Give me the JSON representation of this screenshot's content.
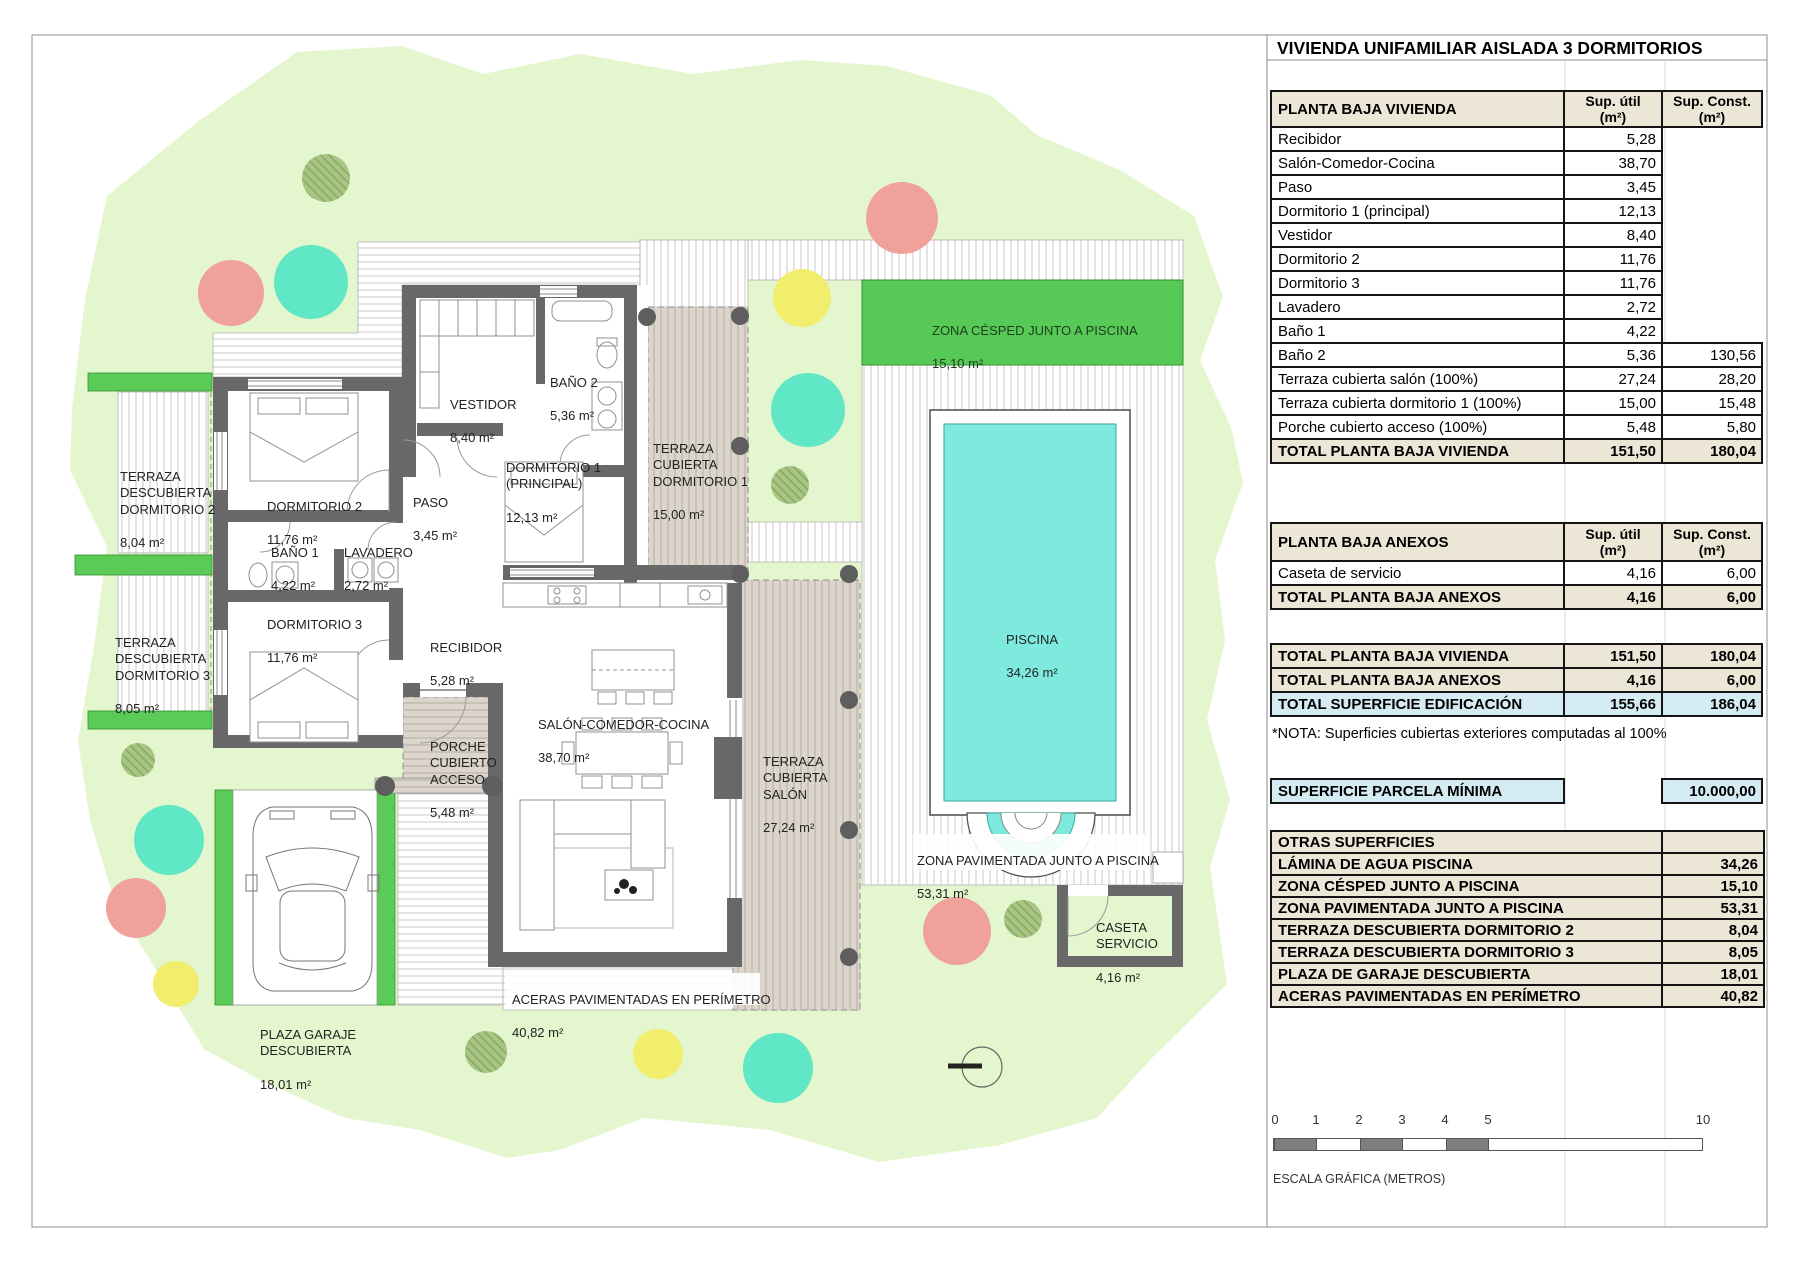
{
  "title": "VIVIENDA UNIFAMILIAR AISLADA 3 DORMITORIOS",
  "colors": {
    "garden": "#e3f6cd",
    "grass_bright": "#57c957",
    "pool_water": "#7eeade",
    "wall": "#686868",
    "terrace_beige": "#dcd5cb",
    "table_header_beige": "#ece6d7",
    "highlight_blue": "#d4ebf4",
    "tree_salmon": "#efa19a",
    "tree_teal": "#5fe7c6",
    "tree_yellow": "#f1ee6d",
    "tree_olive": "#a8c584"
  },
  "col_headers": {
    "util": "Sup. útil\n(m²)",
    "const": "Sup. Const.\n(m²)"
  },
  "tables": {
    "vivienda": {
      "header": "PLANTA BAJA VIVIENDA",
      "rows": [
        {
          "label": "Recibidor",
          "util": "5,28",
          "const": ""
        },
        {
          "label": "Salón-Comedor-Cocina",
          "util": "38,70",
          "const": ""
        },
        {
          "label": "Paso",
          "util": "3,45",
          "const": ""
        },
        {
          "label": "Dormitorio 1 (principal)",
          "util": "12,13",
          "const": ""
        },
        {
          "label": "Vestidor",
          "util": "8,40",
          "const": ""
        },
        {
          "label": "Dormitorio 2",
          "util": "11,76",
          "const": ""
        },
        {
          "label": "Dormitorio 3",
          "util": "11,76",
          "const": ""
        },
        {
          "label": "Lavadero",
          "util": "2,72",
          "const": ""
        },
        {
          "label": "Baño 1",
          "util": "4,22",
          "const": ""
        },
        {
          "label": "Baño 2",
          "util": "5,36",
          "const": "130,56"
        },
        {
          "label": "Terraza cubierta salón (100%)",
          "util": "27,24",
          "const": "28,20"
        },
        {
          "label": "Terraza cubierta dormitorio 1 (100%)",
          "util": "15,00",
          "const": "15,48"
        },
        {
          "label": "Porche cubierto acceso (100%)",
          "util": "5,48",
          "const": "5,80"
        }
      ],
      "total": {
        "label": "TOTAL PLANTA BAJA VIVIENDA",
        "util": "151,50",
        "const": "180,04"
      }
    },
    "anexos": {
      "header": "PLANTA BAJA ANEXOS",
      "rows": [
        {
          "label": "Caseta de servicio",
          "util": "4,16",
          "const": "6,00"
        }
      ],
      "total": {
        "label": "TOTAL PLANTA BAJA ANEXOS",
        "util": "4,16",
        "const": "6,00"
      }
    },
    "resumen": {
      "row1": {
        "label": "TOTAL PLANTA BAJA VIVIENDA",
        "util": "151,50",
        "const": "180,04"
      },
      "row2": {
        "label": "TOTAL PLANTA BAJA ANEXOS",
        "util": "4,16",
        "const": "6,00"
      },
      "row3": {
        "label": "TOTAL SUPERFICIE EDIFICACIÓN",
        "util": "155,66",
        "const": "186,04"
      }
    },
    "nota": "*NOTA: Superficies cubiertas exteriores computadas al 100%",
    "parcela": {
      "label": "SUPERFICIE PARCELA MÍNIMA",
      "value": "10.000,00"
    },
    "otras": {
      "header": "OTRAS SUPERFICIES",
      "rows": [
        {
          "label": "LÁMINA DE AGUA PISCINA",
          "value": "34,26"
        },
        {
          "label": "ZONA CÉSPED JUNTO A PISCINA",
          "value": "15,10"
        },
        {
          "label": "ZONA PAVIMENTADA JUNTO A PISCINA",
          "value": "53,31"
        },
        {
          "label": "TERRAZA DESCUBIERTA DORMITORIO 2",
          "value": "8,04"
        },
        {
          "label": "TERRAZA DESCUBIERTA DORMITORIO 3",
          "value": "8,05"
        },
        {
          "label": "PLAZA DE GARAJE DESCUBIERTA",
          "value": "18,01"
        },
        {
          "label": "ACERAS PAVIMENTADAS EN PERÍMETRO",
          "value": "40,82"
        }
      ]
    }
  },
  "plan": {
    "labels": {
      "terraza_dorm2": {
        "name": "TERRAZA\nDESCUBIERTA\nDORMITORIO 2",
        "area": "8,04 m²"
      },
      "terraza_dorm3": {
        "name": "TERRAZA\nDESCUBIERTA\nDORMITORIO 3",
        "area": "8,05 m²"
      },
      "dormitorio2": {
        "name": "DORMITORIO 2",
        "area": "11,76 m²"
      },
      "bano1": {
        "name": "BAÑO 1",
        "area": "4,22 m²"
      },
      "lavadero": {
        "name": "LAVADERO",
        "area": "2,72 m²"
      },
      "dormitorio3": {
        "name": "DORMITORIO 3",
        "area": "11,76 m²"
      },
      "paso": {
        "name": "PASO",
        "area": "3,45 m²"
      },
      "vestidor": {
        "name": "VESTIDOR",
        "area": "8,40 m²"
      },
      "bano2": {
        "name": "BAÑO 2",
        "area": "5,36 m²"
      },
      "dormitorio1": {
        "name": "DORMITORIO 1\n(PRINCIPAL)",
        "area": "12,13 m²"
      },
      "terraza_cub_dorm1": {
        "name": "TERRAZA\nCUBIERTA\nDORMITORIO 1",
        "area": "15,00 m²"
      },
      "recibidor": {
        "name": "RECIBIDOR",
        "area": "5,28 m²"
      },
      "salon": {
        "name": "SALÓN-COMEDOR-COCINA",
        "area": "38,70 m²"
      },
      "porche": {
        "name": "PORCHE\nCUBIERTO\nACCESO",
        "area": "5,48 m²"
      },
      "terraza_cub_salon": {
        "name": "TERRAZA\nCUBIERTA\nSALÓN",
        "area": "27,24 m²"
      },
      "aceras": {
        "name": "ACERAS PAVIMENTADAS EN PERÍMETRO",
        "area": "40,82 m²"
      },
      "plaza_garaje": {
        "name": "PLAZA GARAJE\nDESCUBIERTA",
        "area": "18,01 m²"
      },
      "zona_cesped": {
        "name": "ZONA CÉSPED JUNTO A PISCINA",
        "area": "15,10 m²"
      },
      "piscina": {
        "name": "PISCINA",
        "area": "34,26 m²"
      },
      "zona_pavimentada": {
        "name": "ZONA PAVIMENTADA JUNTO A PISCINA",
        "area": "53,31 m²"
      },
      "caseta": {
        "name": "CASETA\nSERVICIO",
        "area": "4,16 m²"
      }
    }
  },
  "scale": {
    "ticks": [
      "0",
      "1",
      "2",
      "3",
      "4",
      "5",
      "10"
    ],
    "label": "ESCALA GRÁFICA (METROS)"
  }
}
